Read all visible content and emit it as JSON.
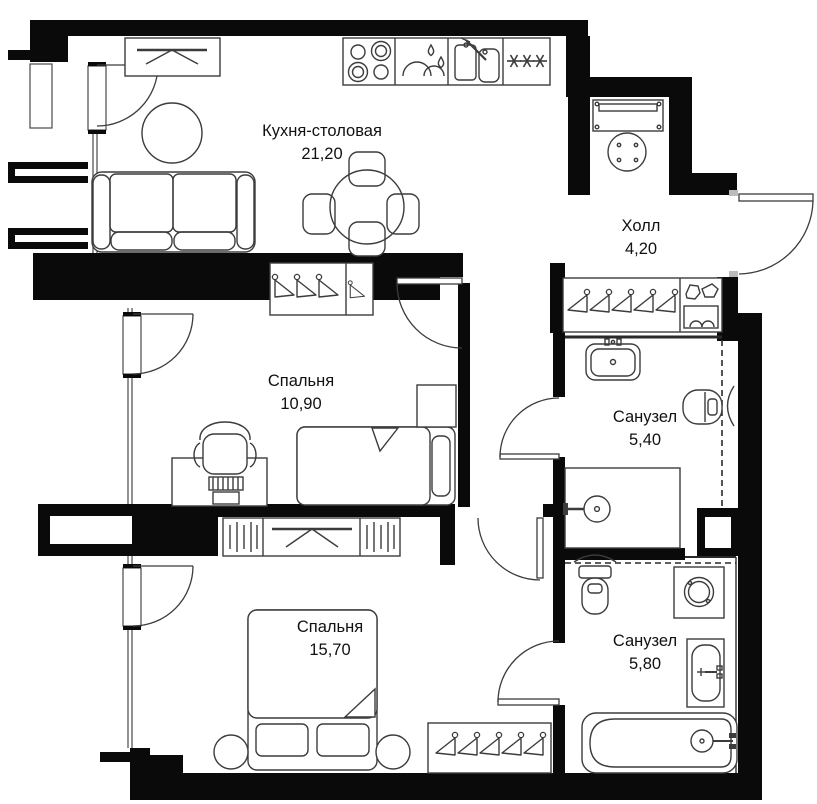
{
  "plan": {
    "title": "Apartment floor plan",
    "colors": {
      "wall": "#0a0a0a",
      "line": "#3c3c3c",
      "background": "#ffffff"
    },
    "rooms": [
      {
        "id": "kitchen-dining",
        "name": "Кухня-столовая",
        "area": "21,20",
        "fixtures": [
          "tv-console",
          "sofa",
          "coffee-table",
          "dining-table",
          "four-chairs",
          "stove-icon",
          "dishwasher-icon",
          "sink-icon",
          "fridge-snowflakes-icon",
          "balcony-door"
        ]
      },
      {
        "id": "hall",
        "name": "Холл",
        "area": "4,20",
        "fixtures": [
          "console-table",
          "round-stool",
          "entrance-door",
          "wardrobe-hangers-icon",
          "shoe-rack-icon"
        ]
      },
      {
        "id": "bedroom-1",
        "name": "Спальня",
        "area": "10,90",
        "fixtures": [
          "wardrobe-hangers-icon",
          "desk",
          "office-chair",
          "single-bed",
          "nightstand",
          "balcony-door"
        ]
      },
      {
        "id": "bathroom-1",
        "name": "Санузел",
        "area": "5,40",
        "fixtures": [
          "washbasin-icon",
          "toilet-icon",
          "shower-icon",
          "towel-radiator-icon",
          "duct-shaft"
        ]
      },
      {
        "id": "bedroom-2",
        "name": "Спальня",
        "area": "15,70",
        "fixtures": [
          "tv-dresser",
          "double-bed",
          "two-round-nightstands",
          "wardrobe-hangers-icon",
          "balcony-door"
        ]
      },
      {
        "id": "bathroom-2",
        "name": "Санузел",
        "area": "5,80",
        "fixtures": [
          "toilet-icon",
          "washing-machine-icon",
          "washbasin-icon",
          "bathtub-icon",
          "towel-radiator-icon"
        ]
      }
    ]
  }
}
